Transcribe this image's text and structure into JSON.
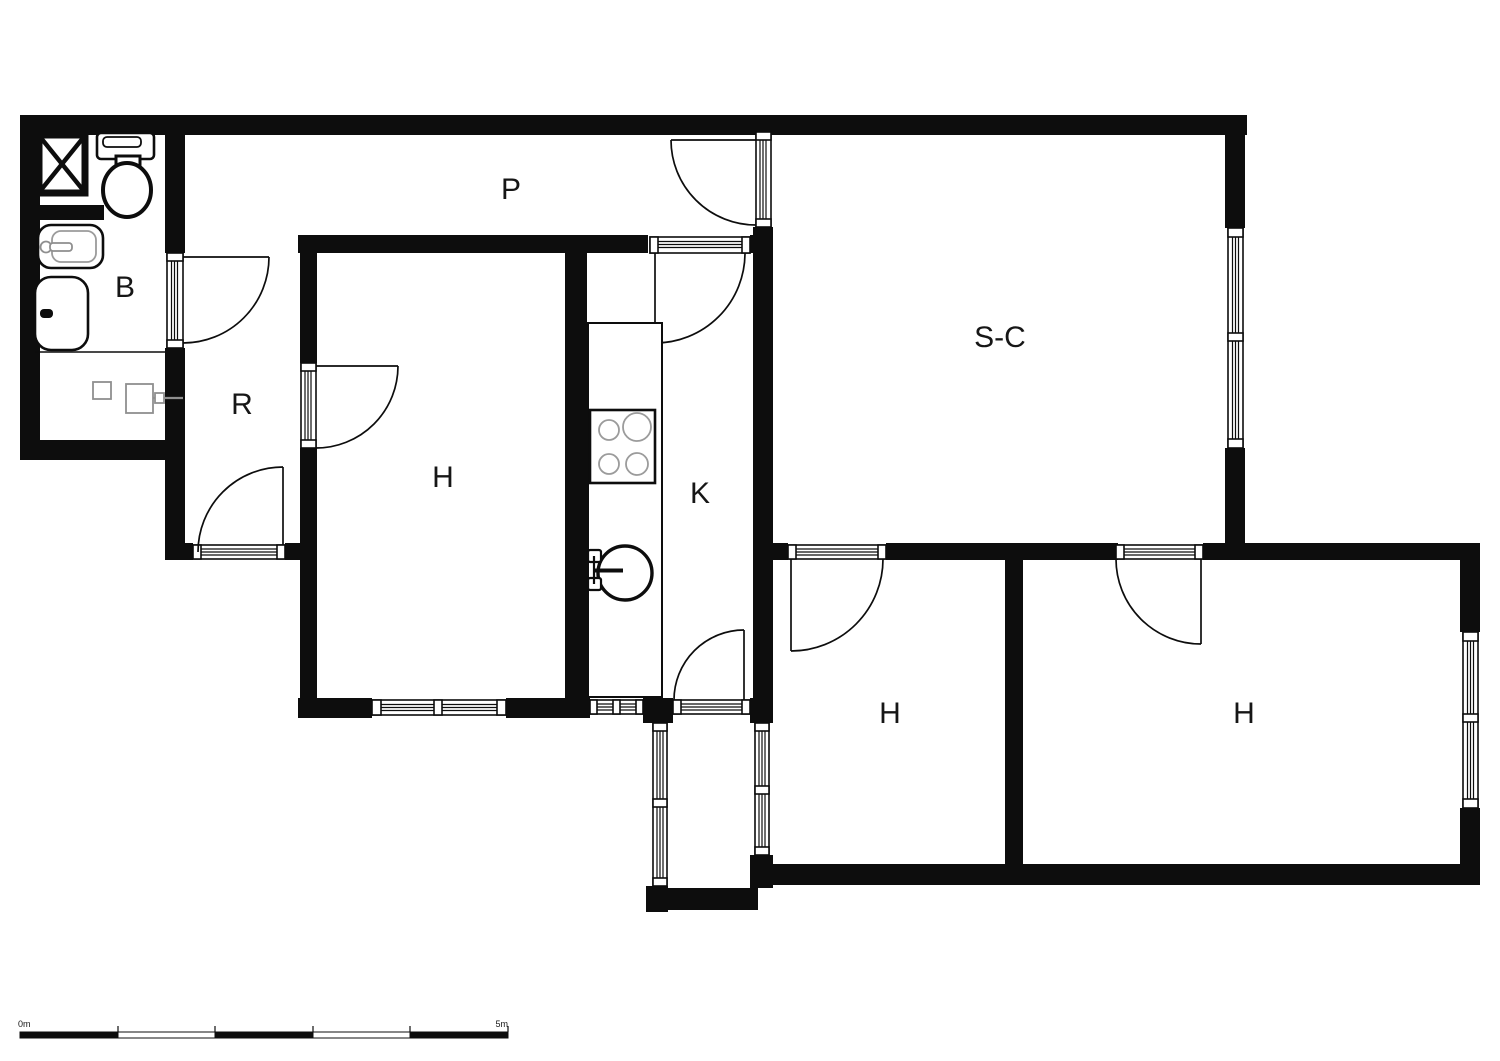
{
  "plan_title": "apartment-floor-plan",
  "rooms": [
    {
      "id": "hallway",
      "label": "P"
    },
    {
      "id": "bathroom",
      "label": "B"
    },
    {
      "id": "vestibule",
      "label": "R"
    },
    {
      "id": "bedroom-left",
      "label": "H"
    },
    {
      "id": "kitchen",
      "label": "K"
    },
    {
      "id": "living-room",
      "label": "S-C"
    },
    {
      "id": "bedroom-middle",
      "label": "H"
    },
    {
      "id": "bedroom-right",
      "label": "H"
    }
  ],
  "scale_bar": {
    "start": "0m",
    "end": "5m"
  },
  "colors": {
    "wall": "#0d0d0d",
    "background": "#ffffff",
    "fixture_outline": "#0d0d0d",
    "fixture_detail": "#9b9b9b"
  },
  "fixtures": [
    "shower",
    "toilet",
    "washbasin",
    "bathtub",
    "storage-units",
    "kitchen-counter",
    "stove",
    "kitchen-sink",
    "glazed-balcony"
  ]
}
